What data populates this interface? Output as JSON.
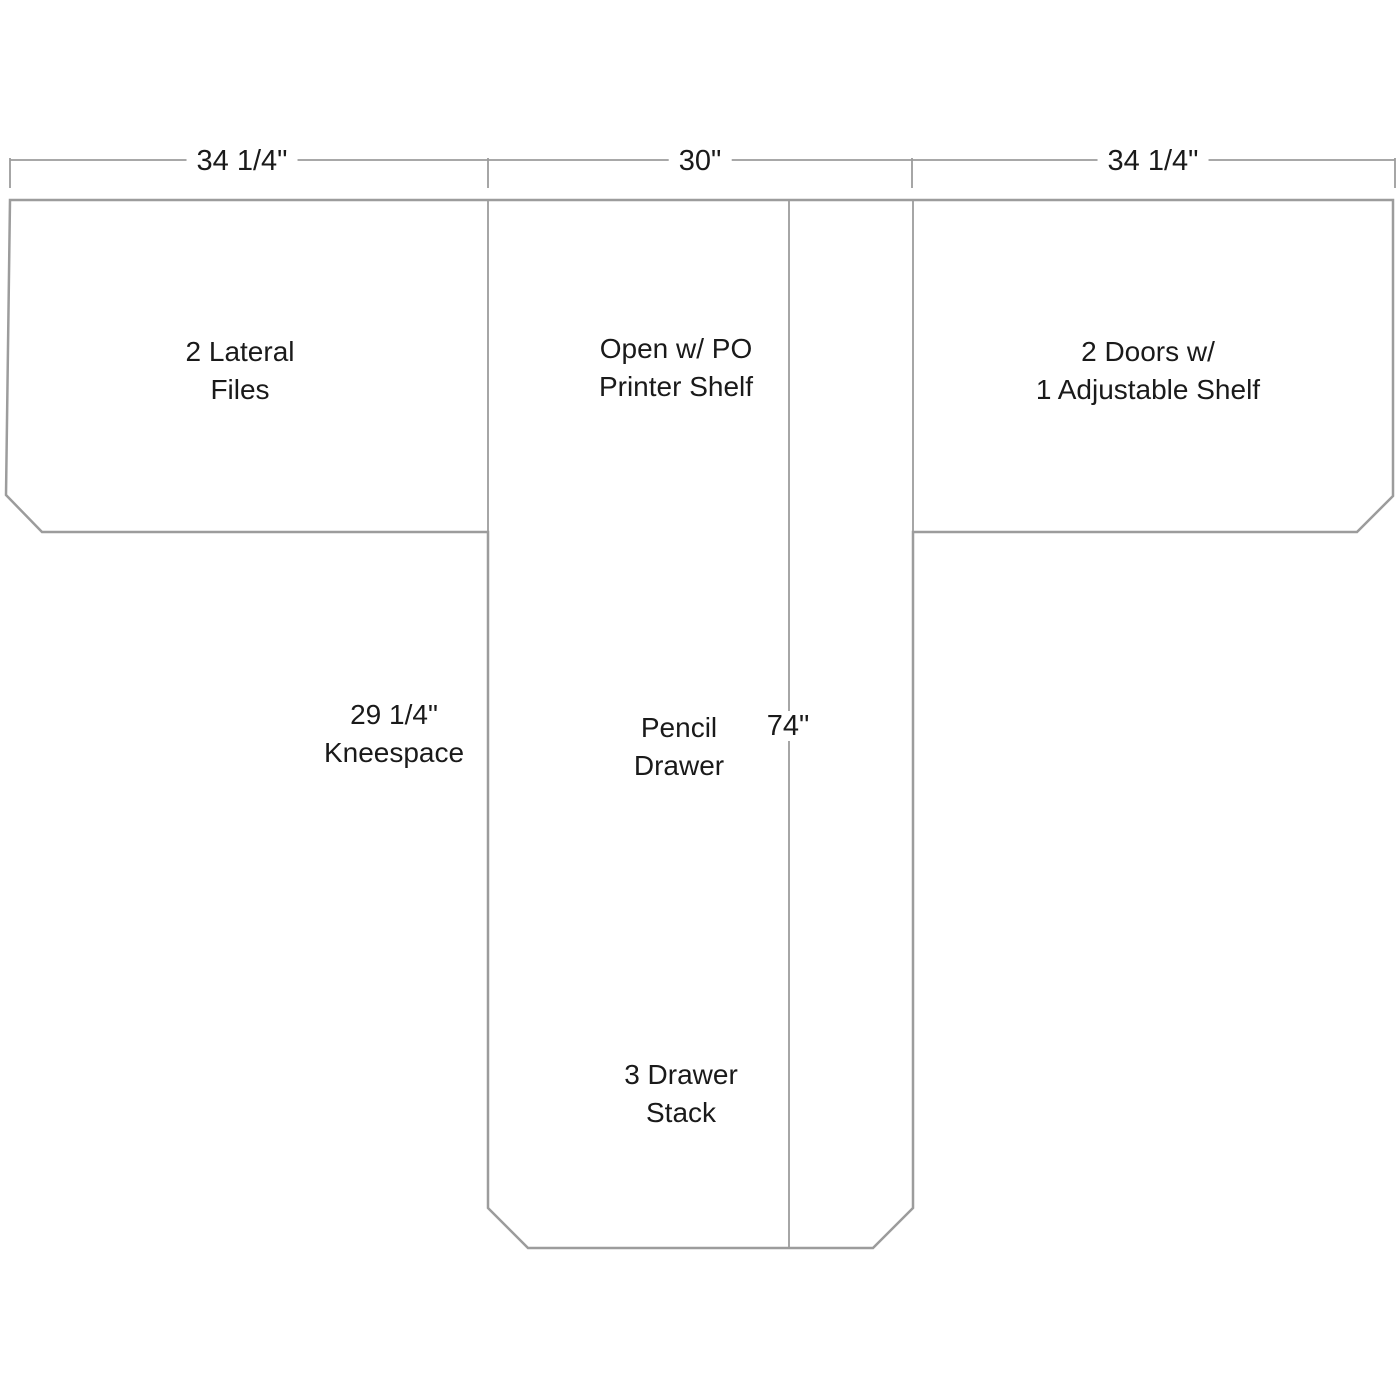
{
  "diagram": {
    "colors": {
      "line": "#9c9c9c",
      "text": "#1a1a1a",
      "label_background": "#ffffff"
    },
    "top_dimensions": {
      "left": "34 1/4\"",
      "center": "30\"",
      "right": "34 1/4\""
    },
    "stem_dimension": "74\"",
    "labels": {
      "left_section": {
        "line1": "2 Lateral",
        "line2": "Files"
      },
      "center_section": {
        "line1": "Open w/ PO",
        "line2": "Printer Shelf"
      },
      "right_section": {
        "line1": "2 Doors w/",
        "line2": "1 Adjustable Shelf"
      },
      "kneespace": {
        "line1": "29 1/4\"",
        "line2": "Kneespace"
      },
      "pencil_drawer": {
        "line1": "Pencil",
        "line2": "Drawer"
      },
      "drawer_stack": {
        "line1": "3 Drawer",
        "line2": "Stack"
      }
    }
  }
}
